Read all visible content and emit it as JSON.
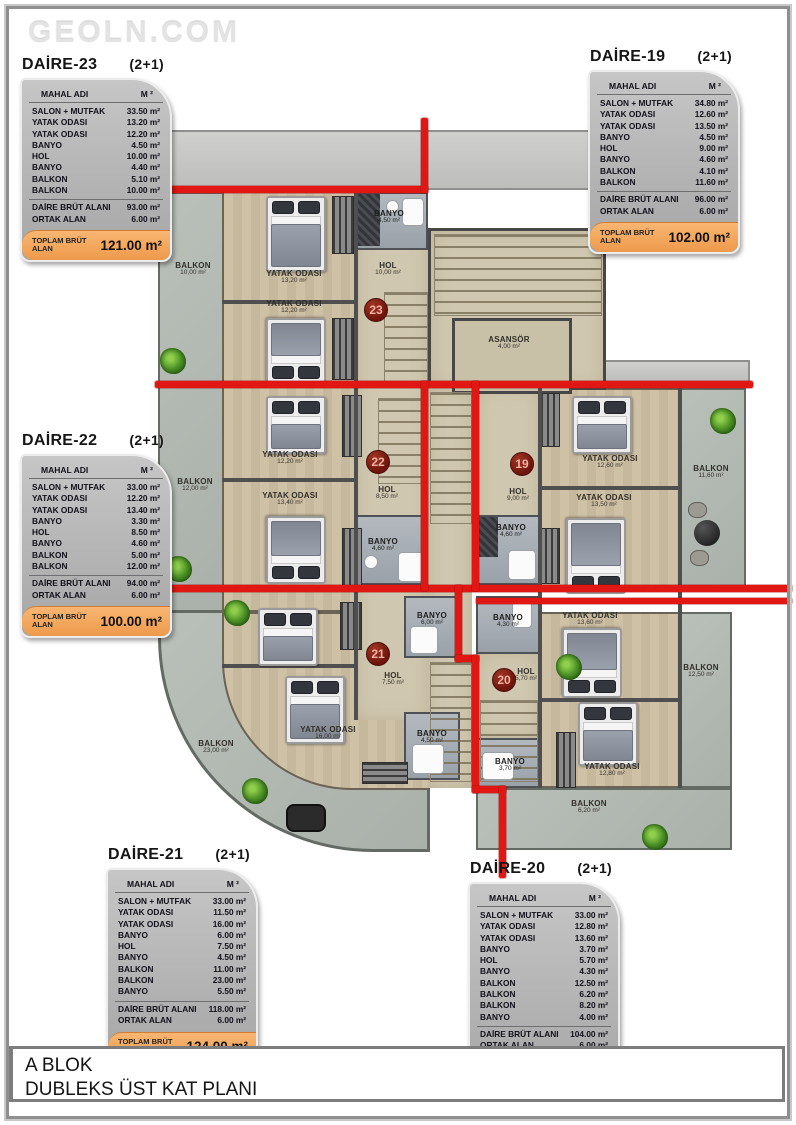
{
  "watermark": "GEOLN.COM",
  "footer": {
    "line1": "A BLOK",
    "line2": "DUBLEKS ÜST KAT PLANI"
  },
  "table_header": {
    "name": "MAHAL ADI",
    "unit": "M ²"
  },
  "units": [
    {
      "name": "DAİRE-23",
      "type": "(2+1)",
      "rows": [
        [
          "SALON + MUTFAK",
          "33.50 m²"
        ],
        [
          "YATAK ODASI",
          "13.20 m²"
        ],
        [
          "YATAK ODASI",
          "12.20 m²"
        ],
        [
          "BANYO",
          "4.50 m²"
        ],
        [
          "HOL",
          "10.00 m²"
        ],
        [
          "BANYO",
          "4.40 m²"
        ],
        [
          "BALKON",
          "5.10 m²"
        ],
        [
          "BALKON",
          "10.00 m²"
        ]
      ],
      "brut_label": "DAİRE BRÜT ALANI",
      "brut": "93.00 m²",
      "ortak_label": "ORTAK ALAN",
      "ortak": "6.00 m²",
      "total_label": "TOPLAM BRÜT ALAN",
      "total": "121.00 m²"
    },
    {
      "name": "DAİRE-19",
      "type": "(2+1)",
      "rows": [
        [
          "SALON + MUTFAK",
          "34.80 m²"
        ],
        [
          "YATAK ODASI",
          "12.60 m²"
        ],
        [
          "YATAK ODASI",
          "13.50 m²"
        ],
        [
          "BANYO",
          "4.50 m²"
        ],
        [
          "HOL",
          "9.00 m²"
        ],
        [
          "BANYO",
          "4.60 m²"
        ],
        [
          "BALKON",
          "4.10 m²"
        ],
        [
          "BALKON",
          "11.60 m²"
        ]
      ],
      "brut_label": "DAİRE BRÜT ALANI",
      "brut": "96.00 m²",
      "ortak_label": "ORTAK ALAN",
      "ortak": "6.00 m²",
      "total_label": "TOPLAM BRÜT ALAN",
      "total": "102.00 m²"
    },
    {
      "name": "DAİRE-22",
      "type": "(2+1)",
      "rows": [
        [
          "SALON + MUTFAK",
          "33.00 m²"
        ],
        [
          "YATAK ODASI",
          "12.20 m²"
        ],
        [
          "YATAK ODASI",
          "13.40 m²"
        ],
        [
          "BANYO",
          "3.30 m²"
        ],
        [
          "HOL",
          "8.50 m²"
        ],
        [
          "BANYO",
          "4.60 m²"
        ],
        [
          "BALKON",
          "5.00 m²"
        ],
        [
          "BALKON",
          "12.00 m²"
        ]
      ],
      "brut_label": "DAİRE BRÜT ALANI",
      "brut": "94.00 m²",
      "ortak_label": "ORTAK ALAN",
      "ortak": "6.00 m²",
      "total_label": "TOPLAM BRÜT ALAN",
      "total": "100.00 m²"
    },
    {
      "name": "DAİRE-21",
      "type": "(2+1)",
      "rows": [
        [
          "SALON + MUTFAK",
          "33.00 m²"
        ],
        [
          "YATAK ODASI",
          "11.50 m²"
        ],
        [
          "YATAK ODASI",
          "16.00 m²"
        ],
        [
          "BANYO",
          "6.00 m²"
        ],
        [
          "HOL",
          "7.50 m²"
        ],
        [
          "BANYO",
          "4.50 m²"
        ],
        [
          "BALKON",
          "11.00 m²"
        ],
        [
          "BALKON",
          "23.00 m²"
        ],
        [
          "BANYO",
          "5.50 m²"
        ]
      ],
      "brut_label": "DAİRE BRÜT ALANI",
      "brut": "118.00 m²",
      "ortak_label": "ORTAK ALAN",
      "ortak": "6.00 m²",
      "total_label": "TOPLAM BRÜT ALAN",
      "total": "124.00 m²"
    },
    {
      "name": "DAİRE-20",
      "type": "(2+1)",
      "rows": [
        [
          "SALON + MUTFAK",
          "33.00 m²"
        ],
        [
          "YATAK ODASI",
          "12.80 m²"
        ],
        [
          "YATAK ODASI",
          "13.60 m²"
        ],
        [
          "BANYO",
          "3.70 m²"
        ],
        [
          "HOL",
          "5.70 m²"
        ],
        [
          "BANYO",
          "4.30 m²"
        ],
        [
          "BALKON",
          "12.50 m²"
        ],
        [
          "BALKON",
          "6.20 m²"
        ],
        [
          "BALKON",
          "8.20 m²"
        ],
        [
          "BANYO",
          "4.00 m²"
        ]
      ],
      "brut_label": "DAİRE BRÜT ALANI",
      "brut": "104.00 m²",
      "ortak_label": "ORTAK ALAN",
      "ortak": "6.00 m²",
      "total_label": "TOPLAM BRÜT ALAN",
      "total": "110.00 m²"
    }
  ],
  "plan": {
    "rooms": [
      {
        "label": "BALKON",
        "area": "10,00 m²"
      },
      {
        "label": "YATAK ODASI",
        "area": "13,20 m²"
      },
      {
        "label": "BANYO",
        "area": "4,50 m²"
      },
      {
        "label": "HOL",
        "area": "10,00 m²"
      },
      {
        "label": "YATAK ODASI",
        "area": "12,20 m²"
      },
      {
        "label": "ASANSÖR",
        "area": "4,00 m²"
      },
      {
        "label": "BALKON",
        "area": "12,00 m²"
      },
      {
        "label": "YATAK ODASI",
        "area": "12,20 m²"
      },
      {
        "label": "HOL",
        "area": "8,50 m²"
      },
      {
        "label": "YATAK ODASI",
        "area": "13,40 m²"
      },
      {
        "label": "BANYO",
        "area": "4,60 m²"
      },
      {
        "label": "YATAK ODASI",
        "area": "12,60 m²"
      },
      {
        "label": "HOL",
        "area": "9,00 m²"
      },
      {
        "label": "YATAK ODASI",
        "area": "13,50 m²"
      },
      {
        "label": "BANYO",
        "area": "4,60 m²"
      },
      {
        "label": "BALKON",
        "area": "11,60 m²"
      },
      {
        "label": "YATAK ODASI",
        "area": "11,50 m²"
      },
      {
        "label": "HOL",
        "area": "7,50 m²"
      },
      {
        "label": "BANYO",
        "area": "6,00 m²"
      },
      {
        "label": "YATAK ODASI",
        "area": "16,00 m²"
      },
      {
        "label": "BALKON",
        "area": "23,00 m²"
      },
      {
        "label": "BANYO",
        "area": "4,50 m²"
      },
      {
        "label": "BANYO",
        "area": "4,30 m²"
      },
      {
        "label": "HOL",
        "area": "5,70 m²"
      },
      {
        "label": "YATAK ODASI",
        "area": "13,60 m²"
      },
      {
        "label": "BANYO",
        "area": "3,70 m²"
      },
      {
        "label": "YATAK ODASI",
        "area": "12,80 m²"
      },
      {
        "label": "BALKON",
        "area": "12,50 m²"
      },
      {
        "label": "BALKON",
        "area": "6,20 m²"
      }
    ],
    "circles": [
      "23",
      "22",
      "21",
      "20",
      "19"
    ]
  },
  "colors": {
    "divider_red": "#e01712",
    "unit_circle": "#6d140b",
    "table_total_orange": "#ef9a4e",
    "wood_floor": "#cabfa5",
    "balcony_gray": "#aeb6af"
  }
}
